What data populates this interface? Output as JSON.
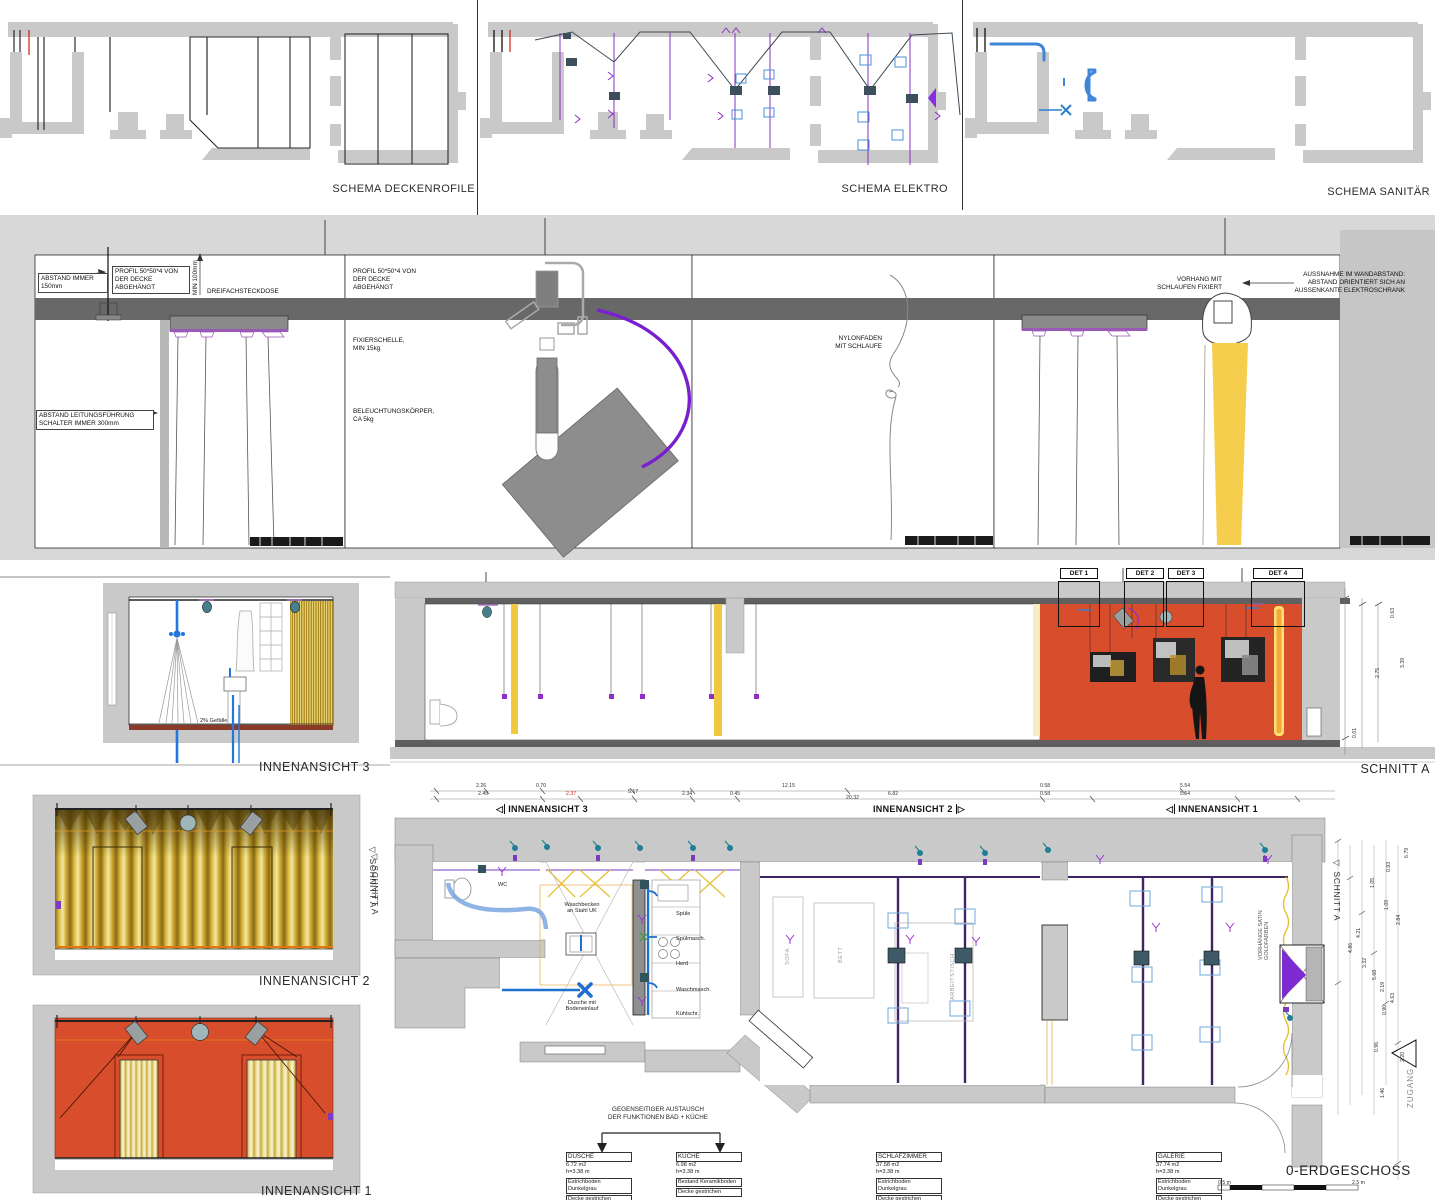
{
  "schemas": {
    "deckenprofile": "SCHEMA DECKENROFILE",
    "elektro": "SCHEMA ELEKTRO",
    "sanitaer": "SCHEMA SANITÄR"
  },
  "details": {
    "abstand_immer": "ABSTAND IMMER\n150mm",
    "profil1": "PROFIL 50*50*4 VON\nDER DECKE\nABGEHÄNGT",
    "min100": "MIN 100mm",
    "dreifachsteckdose": "DREIFACHSTECKDOSE",
    "abstand_leitung": "ABSTAND LEITUNGSFÜHRUNG\nSCHALTER IMMER 300mm",
    "profil2": "PROFIL 50*50*4 VON\nDER DECKE\nABGEHÄNGT",
    "fixierschelle": "FIXIERSCHELLE,\nMIN 15kg",
    "beleuchtung": "BELEUCHTUNGSKÖRPER,\nCA 5kg",
    "nylonfaden": "NYLONFADEN\nMIT SCHLAUFE",
    "vorhang_schlaufen": "VORHANG MIT\nSCHLAUFEN FIXIERT",
    "aussnahme": "AUSSNAHME IM WANDABSTAND:\nABSTAND ORIENTIERT SICH AN\nAUSSENKANTE ELEKTROSCHRANK"
  },
  "views": {
    "i3": "INNENANSICHT 3",
    "i2": "INNENANSICHT 2",
    "i1": "INNENANSICHT 1",
    "gefaelle": "2% Gefälle",
    "schnitt_marker": "◁ SCHNITT A"
  },
  "schnitt": {
    "label": "SCHNITT A",
    "det": [
      "DET 1",
      "DET 2",
      "DET 3",
      "DET 4"
    ],
    "dims": [
      "0.63",
      "3.39",
      "2.75",
      "0.01"
    ]
  },
  "plan": {
    "title": "0-ERDGESCHOSS",
    "tri_left": "◁",
    "tri_right": "▷",
    "marker_i3": "INNENANSICHT 3",
    "marker_i2": "INNENANSICHT 2",
    "marker_i1": "INNENANSICHT 1",
    "marker_schnitt": "◁ SCHNITT A",
    "zugang": "ZUGANG",
    "wc": "WC",
    "waschbecken": "Waschbecken\nan Stahl UK",
    "dusche_note": "Dusche mit\nBodeneinlauf",
    "kitchen_labels": [
      "Spüle",
      "Spülmasch.",
      "Herd",
      "Waschmasch.",
      "Kühlschr."
    ],
    "sofa": "SOFA",
    "bett": "BETT",
    "arbeitstisch": "ARBEITSTISCH",
    "vorhaenge": "VORHÄNGE SATIN\nGOLDFARBEN",
    "exchange_note": "GEGENSEITIGER AUSTAUSCH\nDER FUNKTIONEN BAD + KÜCHE",
    "dims_top_row1": [
      "2.26",
      "0.70",
      "12.15",
      "0.58",
      "5.54"
    ],
    "dims_top_row2": [
      "2.45",
      "2.37",
      "5.17",
      "2.34",
      "0.45",
      "20.32",
      "6.82",
      "0.58",
      "5.54"
    ],
    "dims_right": [
      "6.79",
      "0.93",
      "1.05",
      "1.09",
      "2.84",
      "4.21",
      "4.86",
      "3.32",
      "5.68",
      "2.19",
      "4.63",
      "0.90",
      "0.96",
      "2.20",
      "1.46"
    ],
    "scale_left": "0.5 m",
    "scale_right": "2.5 m",
    "rooms": {
      "dusche": {
        "name": "DUSCHE",
        "area": "6.72 m2",
        "height": "h=3.38 m",
        "floor": "Estrichboden Dunkelgrau",
        "ceiling": "Decke gestrichen"
      },
      "kueche": {
        "name": "KÜCHE",
        "area": "6.98 m2",
        "height": "h=3.38 m",
        "floor": "Bestand Keramikboden",
        "ceiling": "Decke gestrichen"
      },
      "schlafzimmer": {
        "name": "SCHLAFZIMMER",
        "area": "37.58 m2",
        "height": "h=3.38 m",
        "floor": "Estrichboden Dunkelgrau",
        "ceiling": "Decke gestrichen"
      },
      "galerie": {
        "name": "GALERIE",
        "area": "37.74 m2",
        "height": "h=3.38 m",
        "floor": "Estrichboden Dunkelgrau",
        "ceiling": "Decke gestrichen"
      }
    }
  },
  "colors": {
    "wall_gray": "#c9c9c9",
    "beam_gray": "#686868",
    "accent_red": "#d84e2c",
    "gold": "#e8c33c",
    "purple": "#7b2fbe",
    "blue": "#1f6fd0",
    "teal": "#2e7d8c"
  }
}
